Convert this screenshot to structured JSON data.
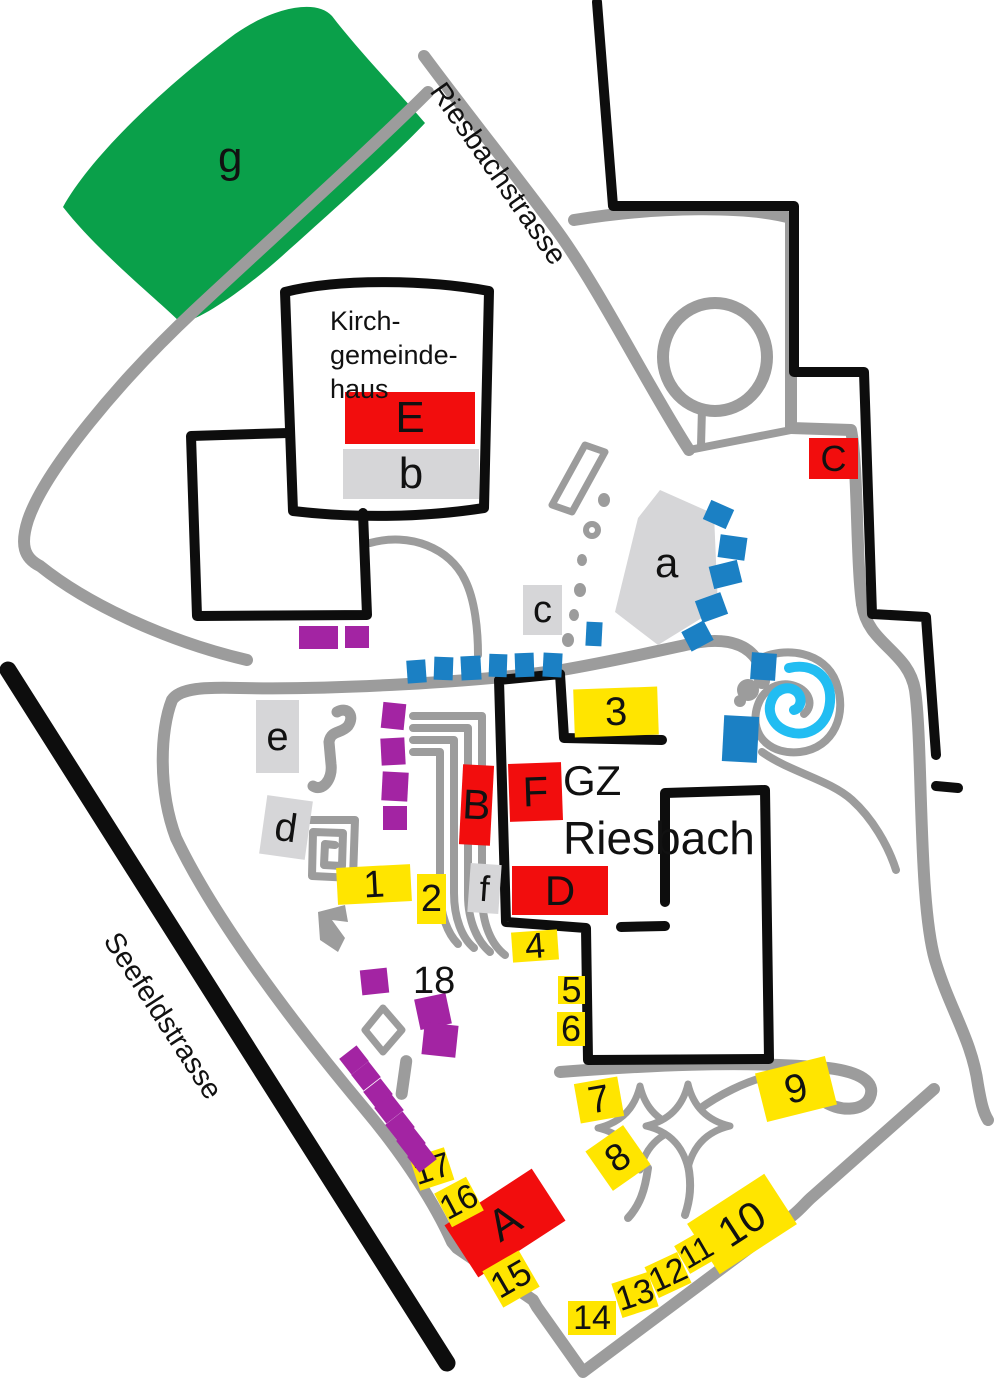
{
  "palette": {
    "red": "#f20d0d",
    "yellow": "#ffe500",
    "green": "#0aa04a",
    "purple": "#a324a3",
    "blue": "#1b80c4",
    "cyan": "#22bdf2",
    "grayfill": "#d6d6d8",
    "road": "#9c9c9c",
    "ink": "#0d0d0d"
  },
  "streets": {
    "riesbach": {
      "label": "Riesbachstrasse"
    },
    "seefeld": {
      "label": "Seefeldstrasse"
    }
  },
  "site": {
    "kirch_line1": "Kirch-",
    "kirch_line2": "gemeinde-",
    "kirch_line3": "haus",
    "gz": "GZ",
    "gz_name": "Riesbach"
  },
  "labels": {
    "A": "A",
    "B": "B",
    "C": "C",
    "D": "D",
    "E": "E",
    "F": "F",
    "a": "a",
    "b": "b",
    "c": "c",
    "d": "d",
    "e": "e",
    "f": "f",
    "g": "g",
    "n1": "1",
    "n2": "2",
    "n3": "3",
    "n4": "4",
    "n5": "5",
    "n6": "6",
    "n7": "7",
    "n8": "8",
    "n9": "9",
    "n10": "10",
    "n11": "11",
    "n12": "12",
    "n13": "13",
    "n14": "14",
    "n15": "15",
    "n16": "16",
    "n17": "17",
    "n18": "18"
  }
}
